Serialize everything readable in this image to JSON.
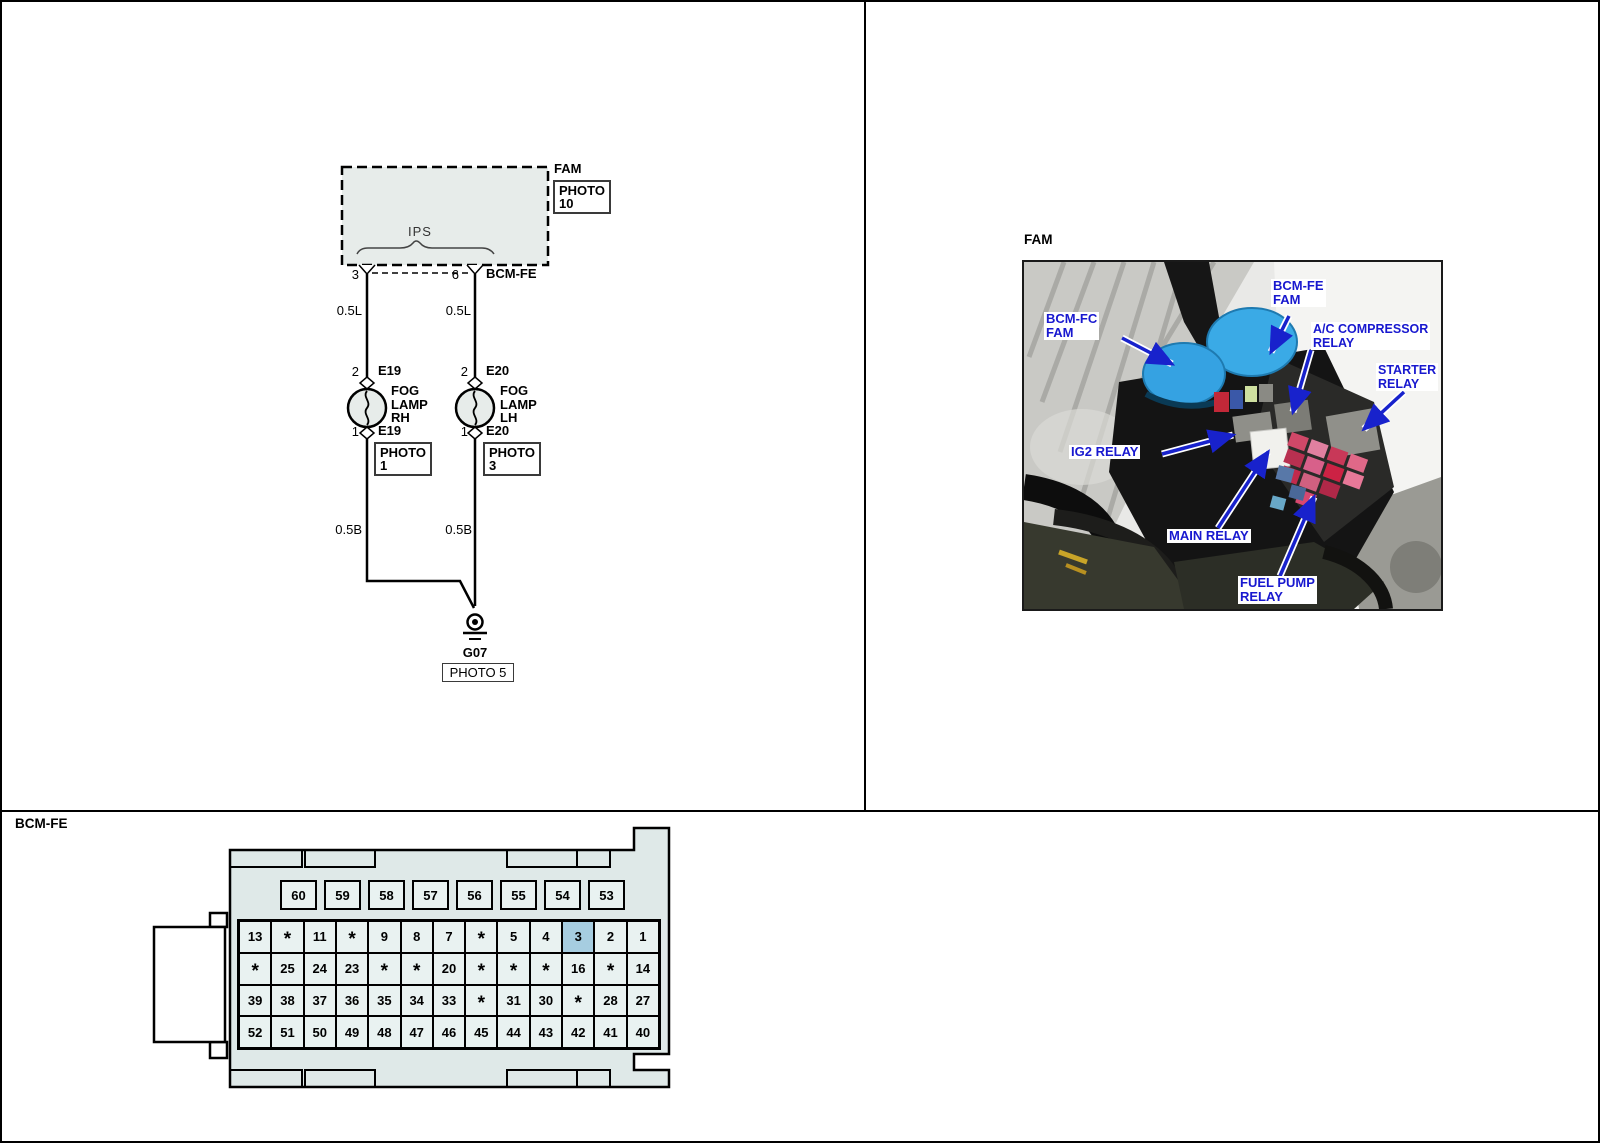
{
  "wiring": {
    "fam_label": "FAM",
    "fam_photo_line1": "PHOTO",
    "fam_photo_line2": "10",
    "ips_label": "IPS",
    "pin_left": "3",
    "pin_right": "6",
    "connector_label": "BCM-FE",
    "wire_left_upper": "0.5L",
    "wire_right_upper": "0.5L",
    "wire_left_lower": "0.5B",
    "wire_right_lower": "0.5B",
    "lamp_rh": {
      "pin_top": "2",
      "conn_top": "E19",
      "name1": "FOG",
      "name2": "LAMP",
      "name3": "RH",
      "pin_bottom": "1",
      "conn_bottom": "E19",
      "photo_line1": "PHOTO",
      "photo_line2": "1"
    },
    "lamp_lh": {
      "pin_top": "2",
      "conn_top": "E20",
      "name1": "FOG",
      "name2": "LAMP",
      "name3": "LH",
      "pin_bottom": "1",
      "conn_bottom": "E20",
      "photo_line1": "PHOTO",
      "photo_line2": "3"
    },
    "ground_label": "G07",
    "ground_photo": "PHOTO 5"
  },
  "photo_panel": {
    "title": "FAM",
    "labels": {
      "bcm_fe1": "BCM-FE",
      "bcm_fe2": "FAM",
      "bcm_fc1": "BCM-FC",
      "bcm_fc2": "FAM",
      "ac1": "A/C COMPRESSOR",
      "ac2": "RELAY",
      "starter1": "STARTER",
      "starter2": "RELAY",
      "ig2": "IG2 RELAY",
      "main": "MAIN RELAY",
      "fuel1": "FUEL PUMP",
      "fuel2": "RELAY"
    }
  },
  "connector_panel": {
    "title": "BCM-FE",
    "top_row": [
      "60",
      "59",
      "58",
      "57",
      "56",
      "55",
      "54",
      "53"
    ],
    "grid": [
      [
        "13",
        "*",
        "11",
        "*",
        "9",
        "8",
        "7",
        "*",
        "5",
        "4",
        "3",
        "2",
        "1"
      ],
      [
        "*",
        "25",
        "24",
        "23",
        "*",
        "*",
        "20",
        "*",
        "*",
        "*",
        "16",
        "*",
        "14"
      ],
      [
        "39",
        "38",
        "37",
        "36",
        "35",
        "34",
        "33",
        "*",
        "31",
        "30",
        "*",
        "28",
        "27"
      ],
      [
        "52",
        "51",
        "50",
        "49",
        "48",
        "47",
        "46",
        "45",
        "44",
        "43",
        "42",
        "41",
        "40"
      ]
    ],
    "highlighted_pin": "3"
  },
  "colors": {
    "diagram_fill": "#e7ecea",
    "connector_body": "#dfe9e8",
    "cell_fill": "#e9f2f1",
    "highlight_fill": "#a6cde0",
    "label_blue": "#1818cf"
  }
}
